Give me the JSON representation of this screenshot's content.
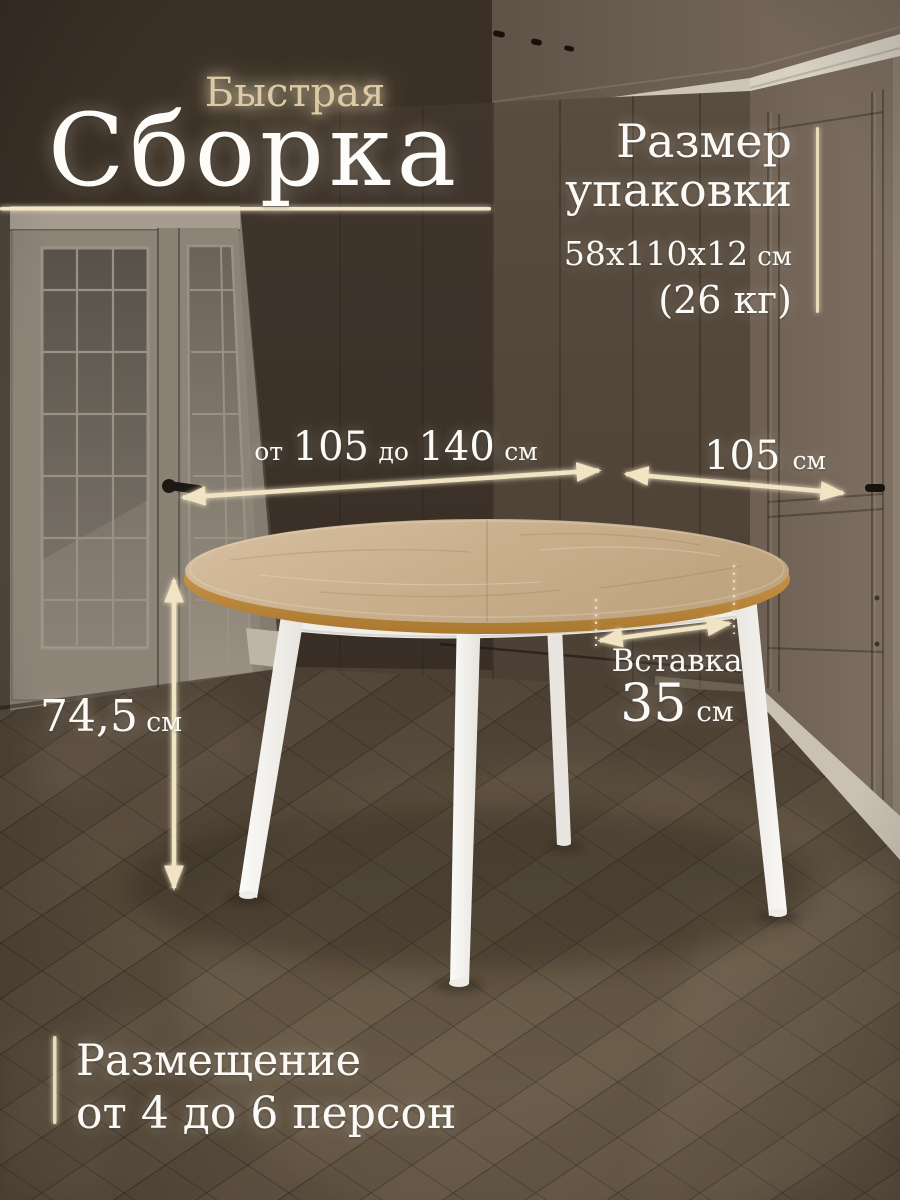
{
  "header": {
    "pre_title": "Быстрая",
    "title": "Сборка"
  },
  "package": {
    "label_line1": "Размер",
    "label_line2": "упаковки",
    "size": "58x110x12",
    "size_unit": "см",
    "weight": "(26 кг)"
  },
  "dimensions": {
    "length": {
      "prefix": "от",
      "min": "105",
      "infix": "до",
      "max": "140",
      "unit": "см"
    },
    "width": {
      "value": "105",
      "unit": "см"
    },
    "height": {
      "value": "74,5",
      "unit": "см"
    },
    "insert": {
      "label": "Вставка",
      "value": "35",
      "unit": "см"
    }
  },
  "seating": {
    "line1": "Размещение",
    "line2": "от 4 до 6 персон"
  },
  "colors": {
    "accent_cream": "#f0e4c3",
    "text_white": "#fbfaf7",
    "pre_title_gold": "#dbcaa5",
    "table_top_wood": "#cbb292",
    "table_edge_oak": "#c08a3e",
    "table_frame_white": "#f5f4f1",
    "wall_dark_brown": "#4a3e33",
    "floor_brown": "#564a3c"
  }
}
